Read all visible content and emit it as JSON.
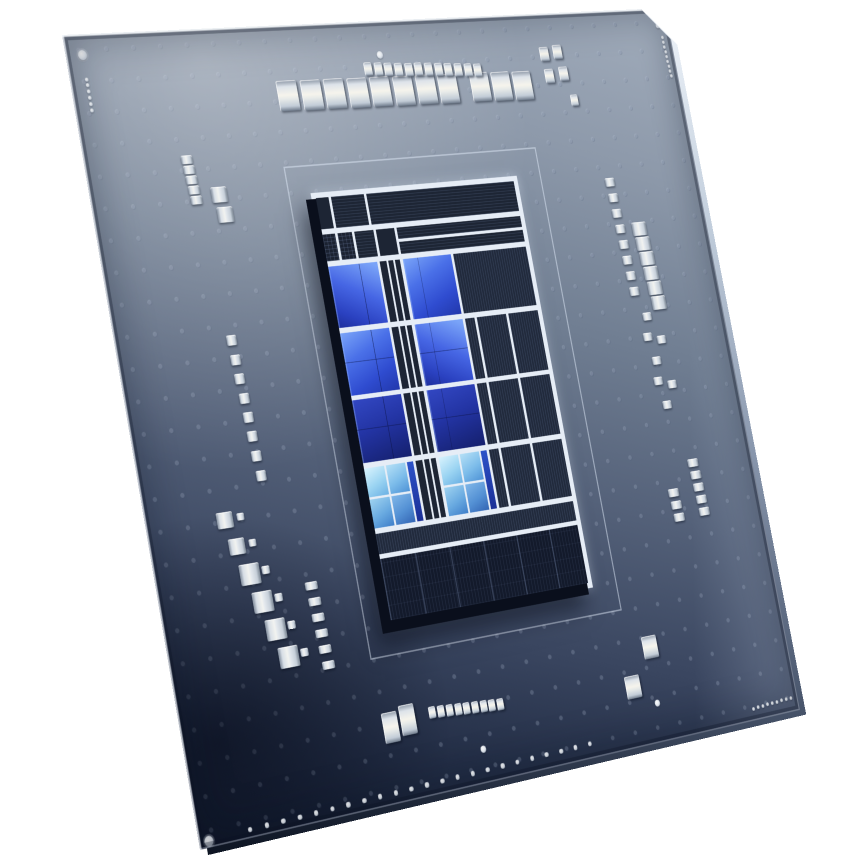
{
  "scene": {
    "description": "Angled studio photo of a desktop CPU package: dark blue substrate with via dot grid, silver decoupling capacitors, white fiducial marks, and a raised rectangular die with bright blue P-core blocks, light-blue E-core cluster tiles and dark striped uncore blocks",
    "background_color": "#ffffff",
    "palette": {
      "bg": "#ffffff",
      "substrate_light": "#a2adbc",
      "substrate_mid": "#55627a",
      "substrate_dark": "#141d31",
      "die_border": "#e6edf6",
      "pcore_bright": "#7aa4f8",
      "pcore_mid": "#4666e4",
      "pcore_deep": "#15206e",
      "ecore_light": "#d9f3fd",
      "ecore_mid": "#4f93d6",
      "cap_metal": "#f2f3f0"
    }
  },
  "geometry": {
    "package_corners": [
      [
        62,
        35
      ],
      [
        665,
        8
      ],
      [
        800,
        710
      ],
      [
        200,
        850
      ]
    ],
    "flat_size": 1000,
    "top_right_chamfer": 46,
    "die_rect": [
      330,
      222,
      344,
      560
    ],
    "outline_rect": [
      295,
      185,
      417,
      630
    ]
  },
  "die": {
    "blocks": [
      [
        "d",
        0,
        0,
        6,
        7.5
      ],
      [
        "ds",
        7.2,
        0,
        16,
        7.5
      ],
      [
        "ds",
        24.4,
        0,
        75.6,
        7.5
      ],
      [
        "g",
        0,
        8.7,
        6,
        6.5
      ],
      [
        "g",
        7.2,
        8.7,
        7,
        6.5
      ],
      [
        "ds",
        15.4,
        8.7,
        9.5,
        6.5
      ],
      [
        "d",
        26.1,
        8.7,
        9,
        6.5
      ],
      [
        "ds",
        36.3,
        8.7,
        63.7,
        2.9
      ],
      [
        "ds",
        36.3,
        12.3,
        63.7,
        2.9
      ],
      [
        "p2",
        0,
        16.4,
        24,
        14.8
      ],
      [
        "p1",
        36.8,
        16.4,
        24,
        14.8
      ],
      [
        "p1",
        0,
        32.4,
        24,
        14.8
      ],
      [
        "p2",
        36.8,
        32.4,
        24,
        14.8
      ],
      [
        "p3",
        0,
        48.4,
        24,
        14.8
      ],
      [
        "p3",
        36.8,
        48.4,
        24,
        14.8
      ],
      [
        "ec",
        0,
        64.4,
        24,
        14.2
      ],
      [
        "ec",
        36.8,
        64.4,
        24,
        14.2
      ],
      [
        "d",
        25.2,
        16.4,
        3.4,
        14.8
      ],
      [
        "d",
        29.4,
        16.4,
        2.4,
        14.8
      ],
      [
        "d",
        32.6,
        16.4,
        2.6,
        14.8
      ],
      [
        "d",
        25.2,
        32.4,
        3.4,
        14.8
      ],
      [
        "d",
        29.4,
        32.4,
        2.4,
        14.8
      ],
      [
        "d",
        32.6,
        32.4,
        2.6,
        14.8
      ],
      [
        "d",
        25.2,
        48.4,
        3.4,
        14.8
      ],
      [
        "d",
        29.4,
        48.4,
        2.4,
        14.8
      ],
      [
        "d",
        32.6,
        48.4,
        2.6,
        14.8
      ],
      [
        "d",
        25.2,
        64.4,
        3.4,
        14.2
      ],
      [
        "d",
        29.4,
        64.4,
        2.4,
        14.2
      ],
      [
        "d",
        32.6,
        64.4,
        2.6,
        14.2
      ],
      [
        "df",
        62,
        16.4,
        38,
        14.8
      ],
      [
        "df",
        62,
        32.4,
        5,
        14.8
      ],
      [
        "df",
        68.2,
        32.4,
        15,
        14.8
      ],
      [
        "df",
        84.4,
        32.4,
        15.6,
        14.8
      ],
      [
        "df",
        62,
        48.4,
        5,
        14.8
      ],
      [
        "df",
        68.2,
        48.4,
        15,
        14.8
      ],
      [
        "df",
        84.4,
        48.4,
        15.6,
        14.8
      ],
      [
        "df",
        62,
        64.4,
        5,
        14.2
      ],
      [
        "df",
        68.2,
        64.4,
        15,
        14.2
      ],
      [
        "df",
        84.4,
        64.4,
        15.6,
        14.2
      ],
      [
        "df",
        0,
        79.8,
        100,
        4.8
      ],
      [
        "df2",
        0,
        85.8,
        100,
        14.2
      ]
    ]
  },
  "capacitors": [
    [
      322,
      93,
      32,
      40
    ],
    [
      360,
      94,
      32,
      40
    ],
    [
      397,
      94,
      32,
      40
    ],
    [
      435,
      95,
      32,
      40
    ],
    [
      472,
      95,
      32,
      40
    ],
    [
      510,
      96,
      32,
      40
    ],
    [
      548,
      96,
      32,
      40
    ],
    [
      585,
      97,
      32,
      40
    ],
    [
      640,
      97,
      32,
      40
    ],
    [
      677,
      98,
      32,
      40
    ],
    [
      714,
      99,
      32,
      40
    ],
    [
      762,
      57,
      16,
      20
    ],
    [
      786,
      55,
      16,
      20
    ],
    [
      764,
      88,
      16,
      20
    ],
    [
      790,
      86,
      16,
      20
    ],
    [
      800,
      124,
      13,
      16
    ],
    [
      457,
      64,
      13,
      18
    ],
    [
      474,
      65,
      13,
      18
    ],
    [
      490,
      66,
      13,
      18
    ],
    [
      507,
      67,
      13,
      18
    ],
    [
      524,
      68,
      13,
      18
    ],
    [
      540,
      68,
      13,
      18
    ],
    [
      557,
      69,
      13,
      18
    ],
    [
      574,
      70,
      13,
      18
    ],
    [
      590,
      71,
      13,
      18
    ],
    [
      607,
      72,
      13,
      18
    ],
    [
      624,
      73,
      13,
      18
    ],
    [
      640,
      74,
      13,
      18
    ],
    [
      150,
      166,
      17,
      11
    ],
    [
      151,
      179,
      17,
      11
    ],
    [
      152,
      192,
      17,
      11
    ],
    [
      153,
      205,
      17,
      11
    ],
    [
      154,
      218,
      17,
      11
    ],
    [
      190,
      214,
      24,
      20
    ],
    [
      194,
      240,
      24,
      20
    ],
    [
      170,
      398,
      15,
      13
    ],
    [
      171,
      423,
      15,
      13
    ],
    [
      172,
      447,
      15,
      13
    ],
    [
      174,
      472,
      15,
      13
    ],
    [
      175,
      496,
      15,
      13
    ],
    [
      176,
      520,
      15,
      13
    ],
    [
      177,
      545,
      15,
      13
    ],
    [
      179,
      570,
      15,
      13
    ],
    [
      115,
      618,
      24,
      20
    ],
    [
      138,
      616,
      11,
      9
    ],
    [
      126,
      652,
      24,
      20
    ],
    [
      149,
      650,
      11,
      9
    ],
    [
      138,
      688,
      30,
      26
    ],
    [
      162,
      686,
      12,
      10
    ],
    [
      150,
      724,
      30,
      26
    ],
    [
      174,
      722,
      12,
      10
    ],
    [
      162,
      760,
      30,
      26
    ],
    [
      186,
      758,
      12,
      10
    ],
    [
      174,
      796,
      30,
      26
    ],
    [
      198,
      794,
      12,
      10
    ],
    [
      225,
      715,
      19,
      10
    ],
    [
      226,
      735,
      19,
      10
    ],
    [
      227,
      755,
      19,
      10
    ],
    [
      228,
      775,
      19,
      10
    ],
    [
      229,
      795,
      19,
      10
    ],
    [
      230,
      815,
      19,
      10
    ],
    [
      836,
      242,
      17,
      12
    ],
    [
      837,
      264,
      17,
      12
    ],
    [
      838,
      286,
      17,
      12
    ],
    [
      839,
      308,
      17,
      12
    ],
    [
      840,
      330,
      17,
      12
    ],
    [
      841,
      352,
      17,
      12
    ],
    [
      842,
      374,
      17,
      12
    ],
    [
      843,
      396,
      17,
      12
    ],
    [
      874,
      310,
      26,
      19
    ],
    [
      876,
      331,
      26,
      19
    ],
    [
      878,
      352,
      26,
      19
    ],
    [
      880,
      373,
      26,
      19
    ],
    [
      882,
      394,
      26,
      19
    ],
    [
      884,
      415,
      26,
      19
    ],
    [
      858,
      432,
      16,
      11
    ],
    [
      852,
      460,
      16,
      11
    ],
    [
      876,
      466,
      16,
      11
    ],
    [
      860,
      494,
      16,
      11
    ],
    [
      856,
      522,
      16,
      11
    ],
    [
      880,
      529,
      16,
      11
    ],
    [
      864,
      556,
      16,
      11
    ],
    [
      890,
      640,
      19,
      11
    ],
    [
      891,
      657,
      19,
      11
    ],
    [
      892,
      674,
      19,
      11
    ],
    [
      893,
      691,
      19,
      11
    ],
    [
      894,
      708,
      19,
      11
    ],
    [
      845,
      676,
      19,
      11
    ],
    [
      846,
      693,
      19,
      11
    ],
    [
      847,
      710,
      19,
      11
    ],
    [
      753,
      874,
      26,
      30
    ],
    [
      711,
      921,
      26,
      30
    ],
    [
      308,
      906,
      24,
      38
    ],
    [
      336,
      901,
      24,
      38
    ],
    [
      375,
      898,
      11,
      15
    ],
    [
      389,
      899,
      11,
      15
    ],
    [
      403,
      900,
      11,
      15
    ],
    [
      417,
      901,
      11,
      15
    ],
    [
      430,
      902,
      11,
      15
    ],
    [
      444,
      903,
      11,
      15
    ],
    [
      458,
      904,
      11,
      15
    ],
    [
      471,
      905,
      11,
      15
    ],
    [
      485,
      906,
      11,
      15
    ]
  ],
  "fiducials": {
    "circles": [
      {
        "x": 24,
        "y": 26,
        "d": 13,
        "kind": "corner-ring"
      },
      {
        "x": 14,
        "y": 992,
        "d": 13,
        "kind": "corner-ring"
      },
      {
        "x": 481,
        "y": 46,
        "d": 10,
        "kind": "dot"
      },
      {
        "x": 445,
        "y": 957,
        "d": 9,
        "kind": "dot"
      },
      {
        "x": 747,
        "y": 948,
        "d": 9,
        "kind": "dot"
      },
      {
        "x": 980,
        "y": 25,
        "d": 8,
        "kind": "dot"
      }
    ],
    "rows": [
      [
        24,
        57,
        24,
        96,
        6,
        5
      ],
      [
        984,
        42,
        987,
        98,
        9,
        5
      ],
      [
        75,
        990,
        620,
        981,
        23,
        6.5
      ],
      [
        915,
        984,
        987,
        981,
        9,
        5
      ]
    ]
  }
}
